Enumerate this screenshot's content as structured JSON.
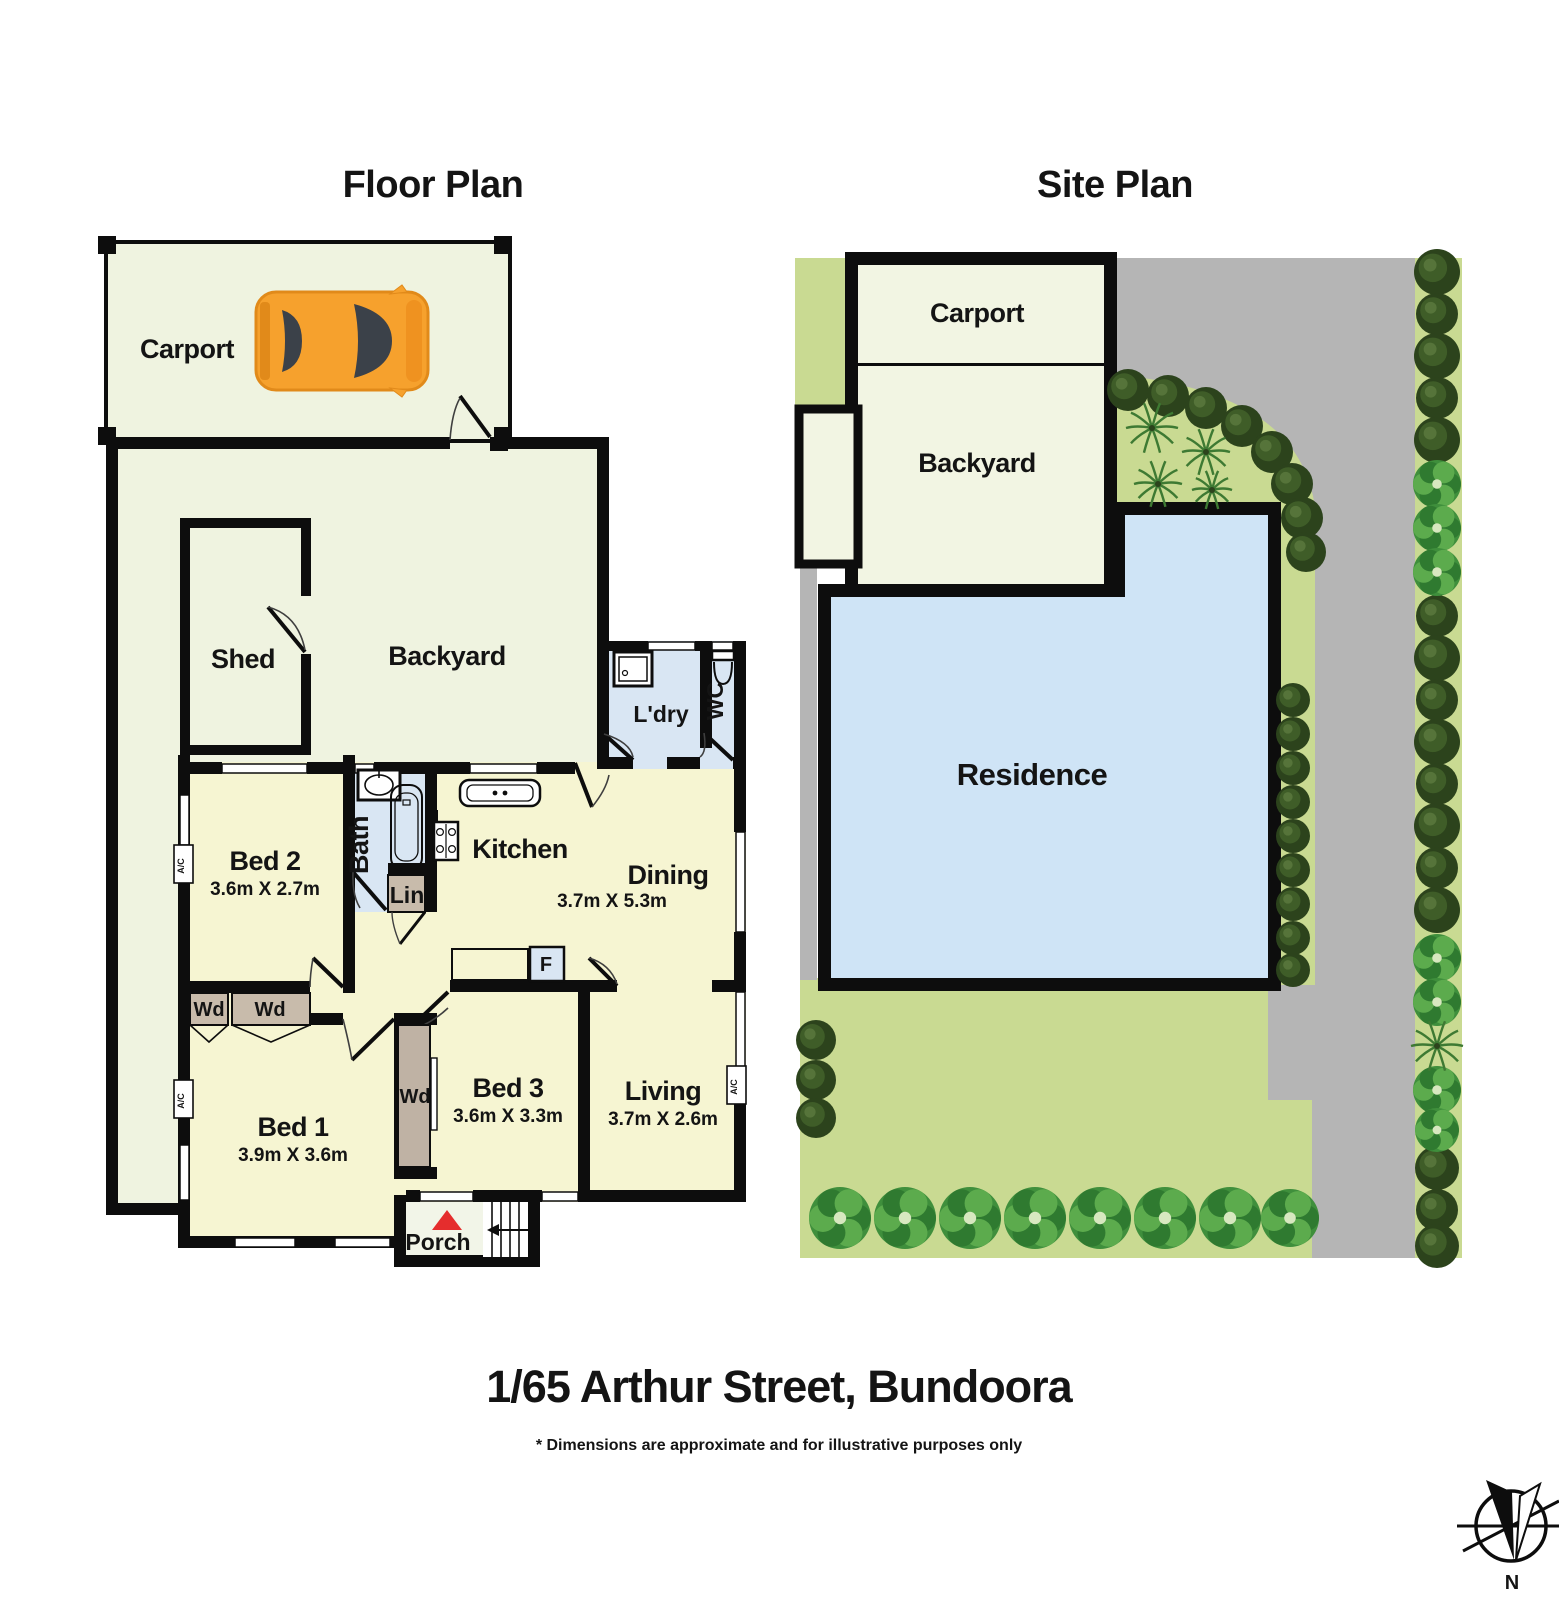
{
  "floor_plan": {
    "title": "Floor Plan",
    "labels": {
      "carport": "Carport",
      "shed": "Shed",
      "backyard": "Backyard",
      "laundry": "L'dry",
      "wc": "WC",
      "bath": "Bath",
      "linen": "Lin",
      "kitchen": "Kitchen",
      "dining": "Dining",
      "dining_dims": "3.7m X 5.3m",
      "bed1": "Bed 1",
      "bed1_dims": "3.9m X 3.6m",
      "bed2": "Bed 2",
      "bed2_dims": "3.6m X 2.7m",
      "bed3": "Bed 3",
      "bed3_dims": "3.6m X 3.3m",
      "living": "Living",
      "living_dims": "3.7m X 2.6m",
      "fridge": "F",
      "wardrobe": "Wd",
      "ac_unit": "A/C",
      "porch": "Porch"
    }
  },
  "site_plan": {
    "title": "Site Plan",
    "labels": {
      "carport": "Carport",
      "backyard": "Backyard",
      "residence": "Residence"
    }
  },
  "footer": {
    "address": "1/65 Arthur Street, Bundoora",
    "disclaimer": "* Dimensions are approximate and for illustrative purposes only"
  },
  "compass": {
    "label": "N"
  },
  "palette": {
    "wall": "#0d0d0d",
    "outdoor_cream": "#eff3e0",
    "room_yellow": "#f6f5d2",
    "wet_blue": "#d9e6f3",
    "storage_tan": "#c8bbab",
    "residence_blue": "#cfe4f6",
    "grass_green": "#c9da92",
    "road_grey": "#b5b5b5",
    "site_cream": "#f2f5e3",
    "tree_dark": "#2c431c",
    "bush_green": "#3f8f3c",
    "car_orange": "#f6a12d",
    "glass_dark": "#3b4149",
    "entry_red": "#e52d2d"
  }
}
